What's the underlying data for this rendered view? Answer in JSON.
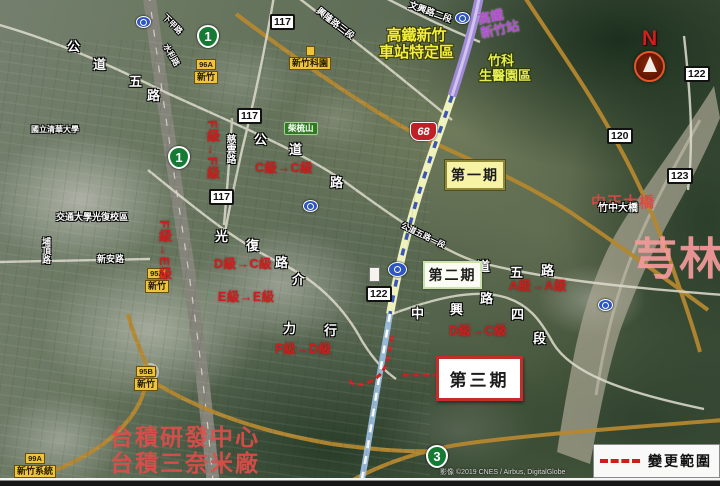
{
  "map_type": "satellite",
  "compass": {
    "north_label": "N"
  },
  "legend": {
    "label": "變更範圍"
  },
  "attribution": "影像 ©2019 CNES / Airbus, DigitalGlobe",
  "phases": [
    {
      "label": "第一期"
    },
    {
      "label": "第二期"
    },
    {
      "label": "第三期"
    }
  ],
  "grade_changes": [
    {
      "text": "F級→F級"
    },
    {
      "text": "F級→E級"
    },
    {
      "text": "C級→C級"
    },
    {
      "text": "D級→C級"
    },
    {
      "text": "E級→E級"
    },
    {
      "text": "F級→D級"
    },
    {
      "text": "A級→A級"
    },
    {
      "text": "D級→C級"
    }
  ],
  "district_labels": {
    "hsr_station": {
      "line1": "高鐵",
      "line2": "新竹站"
    },
    "hsr_district": {
      "line1": "高鐵新竹",
      "line2": "車站特定區"
    },
    "biomed_park": {
      "line1": "竹科",
      "line2": "生醫園區"
    },
    "bridge": "中正大橋",
    "qionglin": "芎林",
    "tsmc_rd": "台積研發中心",
    "tsmc_fab": "台積三奈米廠"
  },
  "route_shields": {
    "provincial": [
      {
        "number": "1"
      },
      {
        "number": "1"
      },
      {
        "number": "3"
      }
    ],
    "expressway": {
      "number": "68"
    },
    "county": [
      {
        "number": "117"
      },
      {
        "number": "117"
      },
      {
        "number": "117"
      },
      {
        "number": "120"
      },
      {
        "number": "122"
      },
      {
        "number": "123"
      },
      {
        "number": "122"
      }
    ]
  },
  "interchange_signs": [
    {
      "code": "96A",
      "name": "新竹"
    },
    {
      "code": "95A",
      "name": "新竹"
    },
    {
      "code": "95B",
      "name": "新竹"
    },
    {
      "code": "99A",
      "name": "新竹系統"
    }
  ],
  "poi_signs": {
    "science_park": "新竹科園",
    "hill": "柴梳山"
  },
  "road_labels": [
    {
      "text": "公"
    },
    {
      "text": "道"
    },
    {
      "text": "五"
    },
    {
      "text": "路"
    },
    {
      "text": "公"
    },
    {
      "text": "道"
    },
    {
      "text": "路"
    },
    {
      "text": "道"
    },
    {
      "text": "五"
    },
    {
      "text": "路"
    },
    {
      "text": "中"
    },
    {
      "text": "興"
    },
    {
      "text": "路"
    },
    {
      "text": "四"
    },
    {
      "text": "段"
    },
    {
      "text": "光"
    },
    {
      "text": "復"
    },
    {
      "text": "路"
    },
    {
      "text": "介"
    },
    {
      "text": "力"
    },
    {
      "text": "行"
    },
    {
      "text": "慈雲路"
    },
    {
      "text": "新安路"
    },
    {
      "text": "文興路二段"
    },
    {
      "text": "興隆路三段"
    },
    {
      "text": "公道五路一段"
    },
    {
      "text": "下甲路"
    },
    {
      "text": "水利路"
    },
    {
      "text": "竹中大橋"
    },
    {
      "text": "交通大學光復校區"
    },
    {
      "text": "國立清華大學"
    },
    {
      "text": "埔頂路"
    }
  ],
  "colors": {
    "grade_text": "#cf1d1d",
    "phase3_border": "#c03028",
    "hsr_line": "#a08ad6",
    "construction_dash": "#3b56b2",
    "change_scope": "#cc2020"
  }
}
